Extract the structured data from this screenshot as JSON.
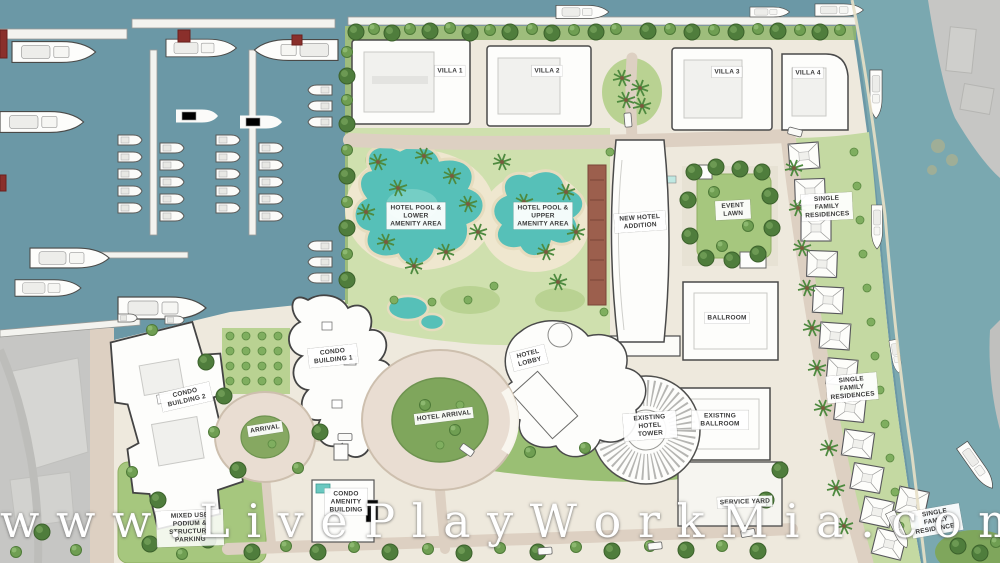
{
  "site_plan": {
    "watermark": "w w w . L i v e P l a y W o r k M i a . c o m",
    "labels": {
      "villa_1": "VILLA 1",
      "villa_2": "VILLA 2",
      "villa_3": "VILLA 3",
      "villa_4": "VILLA 4",
      "hotel_pool_lower": "HOTEL POOL & LOWER AMENITY AREA",
      "hotel_pool_upper": "HOTEL POOL & UPPER AMENITY AREA",
      "new_hotel_addition": "NEW HOTEL ADDITION",
      "event_lawn": "EVENT LAWN",
      "single_family_residences_north": "SINGLE FAMILY RESIDENCES",
      "single_family_residences_mid": "SINGLE FAMILY RESIDENCES",
      "single_family_residences_south": "SINGLE FAMILY RESIDENCES",
      "ballroom": "BALLROOM",
      "hotel_lobby": "HOTEL LOBBY",
      "existing_hotel_tower": "EXISTING HOTEL TOWER",
      "existing_ballroom": "EXISTING BALLROOM",
      "service_yard": "SERVICE YARD",
      "hotel_arrival": "HOTEL ARRIVAL",
      "condo_building_1": "CONDO BUILDING 1",
      "condo_building_2": "CONDO BUILDING 2",
      "arrival": "ARRIVAL",
      "condo_amenity_building": "CONDO AMENITY BUILDING",
      "podium_parking": "MIXED USE PODIUM & STRUCTURE PARKING"
    },
    "colors": {
      "marina_water": "#6b98a6",
      "canal_water": "#7aa8b0",
      "pool_water": "#56c0b8",
      "site_ground": "#eee9dd",
      "lawn_green": "#a6c77e",
      "tree_green": "#5e8f46",
      "road_tan": "#ddd0c2",
      "context_gray": "#c6c6c4",
      "building_white": "#fdfdfb",
      "accent_red": "#8a2f2b"
    }
  }
}
